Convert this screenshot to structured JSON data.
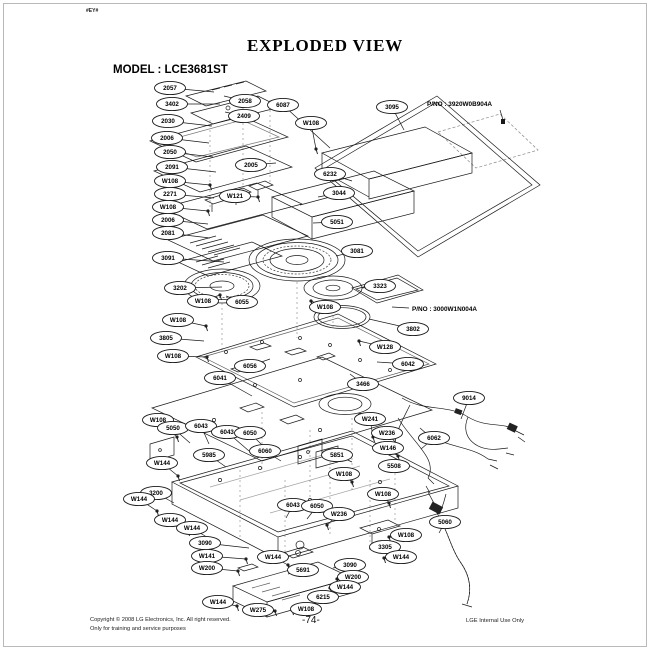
{
  "page": {
    "corner_mark": "#EY#",
    "title": "EXPLODED VIEW",
    "model_label": "MODEL : LCE3681ST",
    "footer": {
      "copyright_line1": "Copyright © 2008 LG Electronics, Inc. All right reserved.",
      "copyright_line2": "Only for training and service purposes",
      "page_number": "-74-",
      "right_note": "LGE Internal Use Only"
    }
  },
  "diagram": {
    "pno_labels": [
      {
        "text": "P/NO : 3920W0B904A",
        "x": 427,
        "y": 106,
        "lx": 500,
        "ly": 110,
        "tx": 503,
        "ty": 120
      },
      {
        "text": "P/NO : 3000W1N004A",
        "x": 412,
        "y": 311,
        "lx": 409,
        "ly": 308,
        "tx": 392,
        "ty": 307
      }
    ],
    "part_labels": [
      {
        "label": "2057",
        "x": 170,
        "y": 88,
        "tx": 214,
        "ty": 92
      },
      {
        "label": "3402",
        "x": 172,
        "y": 104,
        "tx": 220,
        "ty": 104
      },
      {
        "label": "2030",
        "x": 168,
        "y": 121,
        "tx": 212,
        "ty": 126
      },
      {
        "label": "2006",
        "x": 167,
        "y": 138,
        "tx": 209,
        "ty": 143
      },
      {
        "label": "2050",
        "x": 170,
        "y": 152,
        "tx": 213,
        "ty": 157
      },
      {
        "label": "2091",
        "x": 172,
        "y": 167,
        "tx": 216,
        "ty": 172
      },
      {
        "label": "W108",
        "x": 170,
        "y": 181,
        "tx": 210,
        "ty": 185
      },
      {
        "label": "2271",
        "x": 170,
        "y": 194,
        "tx": 214,
        "ty": 198
      },
      {
        "label": "W108",
        "x": 168,
        "y": 207,
        "tx": 208,
        "ty": 211
      },
      {
        "label": "2006",
        "x": 168,
        "y": 220,
        "tx": 208,
        "ty": 224
      },
      {
        "label": "2081",
        "x": 168,
        "y": 233,
        "tx": 210,
        "ty": 238
      },
      {
        "label": "3091",
        "x": 168,
        "y": 258,
        "tx": 224,
        "ty": 262
      },
      {
        "label": "3202",
        "x": 180,
        "y": 288,
        "tx": 222,
        "ty": 287
      },
      {
        "label": "W108",
        "x": 203,
        "y": 301,
        "tx": 220,
        "ty": 295
      },
      {
        "label": "6055",
        "x": 242,
        "y": 302,
        "tx": 226,
        "ty": 296
      },
      {
        "label": "W108",
        "x": 178,
        "y": 320,
        "tx": 206,
        "ty": 326
      },
      {
        "label": "3805",
        "x": 166,
        "y": 338,
        "tx": 204,
        "ty": 341
      },
      {
        "label": "W108",
        "x": 173,
        "y": 356,
        "tx": 207,
        "ty": 357
      },
      {
        "label": "2058",
        "x": 245,
        "y": 101,
        "tx": 224,
        "ty": 96
      },
      {
        "label": "2409",
        "x": 244,
        "y": 116,
        "tx": 225,
        "ty": 112
      },
      {
        "label": "6087",
        "x": 283,
        "y": 105,
        "tx": 330,
        "ty": 148
      },
      {
        "label": "W108",
        "x": 311,
        "y": 123,
        "tx": 316,
        "ty": 149
      },
      {
        "label": "3095",
        "x": 392,
        "y": 107,
        "tx": 404,
        "ty": 130
      },
      {
        "label": "2005",
        "x": 251,
        "y": 165,
        "tx": 276,
        "ty": 163
      },
      {
        "label": "W121",
        "x": 235,
        "y": 196,
        "tx": 258,
        "ty": 197
      },
      {
        "label": "6232",
        "x": 330,
        "y": 174,
        "tx": 352,
        "ty": 181
      },
      {
        "label": "3044",
        "x": 339,
        "y": 193,
        "tx": 318,
        "ty": 197
      },
      {
        "label": "5051",
        "x": 337,
        "y": 222,
        "tx": 313,
        "ty": 223
      },
      {
        "label": "3081",
        "x": 357,
        "y": 251,
        "tx": 336,
        "ty": 256
      },
      {
        "label": "3323",
        "x": 380,
        "y": 286,
        "tx": 362,
        "ty": 288
      },
      {
        "label": "W108",
        "x": 325,
        "y": 307,
        "tx": 311,
        "ty": 301
      },
      {
        "label": "3802",
        "x": 413,
        "y": 329,
        "tx": 369,
        "ty": 319
      },
      {
        "label": "W128",
        "x": 385,
        "y": 347,
        "tx": 359,
        "ty": 341
      },
      {
        "label": "6042",
        "x": 408,
        "y": 364,
        "tx": 377,
        "ty": 362
      },
      {
        "label": "3466",
        "x": 363,
        "y": 384,
        "tx": 350,
        "ty": 374
      },
      {
        "label": "6056",
        "x": 250,
        "y": 366,
        "tx": 270,
        "ty": 359
      },
      {
        "label": "6041",
        "x": 220,
        "y": 378,
        "tx": 252,
        "ty": 396
      },
      {
        "label": "9014",
        "x": 469,
        "y": 398,
        "tx": 461,
        "ty": 419
      },
      {
        "label": "W241",
        "x": 370,
        "y": 419,
        "tx": 373,
        "ty": 437
      },
      {
        "label": "W236",
        "x": 387,
        "y": 433,
        "tx": 397,
        "ty": 444
      },
      {
        "label": "W146",
        "x": 388,
        "y": 448,
        "tx": 398,
        "ty": 456
      },
      {
        "label": "6062",
        "x": 434,
        "y": 438,
        "tx": 421,
        "ty": 449
      },
      {
        "label": "5508",
        "x": 394,
        "y": 466,
        "tx": 401,
        "ty": 472
      },
      {
        "label": "W108",
        "x": 158,
        "y": 420,
        "tx": 177,
        "ty": 437
      },
      {
        "label": "5050",
        "x": 173,
        "y": 428,
        "tx": 190,
        "ty": 443
      },
      {
        "label": "6043",
        "x": 201,
        "y": 426,
        "tx": 209,
        "ty": 444
      },
      {
        "label": "6043",
        "x": 227,
        "y": 432,
        "tx": 249,
        "ty": 451
      },
      {
        "label": "6050",
        "x": 250,
        "y": 433,
        "tx": 268,
        "ty": 451
      },
      {
        "label": "6060",
        "x": 265,
        "y": 451,
        "tx": 281,
        "ty": 461
      },
      {
        "label": "5985",
        "x": 209,
        "y": 455,
        "tx": 226,
        "ty": 467
      },
      {
        "label": "5851",
        "x": 337,
        "y": 455,
        "tx": 352,
        "ty": 462
      },
      {
        "label": "W144",
        "x": 162,
        "y": 463,
        "tx": 178,
        "ty": 476
      },
      {
        "label": "W108",
        "x": 344,
        "y": 474,
        "tx": 352,
        "ty": 482
      },
      {
        "label": "3200",
        "x": 156,
        "y": 493,
        "tx": 174,
        "ty": 503
      },
      {
        "label": "W144",
        "x": 139,
        "y": 499,
        "tx": 157,
        "ty": 511
      },
      {
        "label": "6043",
        "x": 293,
        "y": 505,
        "tx": 286,
        "ty": 518
      },
      {
        "label": "6050",
        "x": 317,
        "y": 506,
        "tx": 307,
        "ty": 519
      },
      {
        "label": "W236",
        "x": 339,
        "y": 514,
        "tx": 327,
        "ty": 525
      },
      {
        "label": "W144",
        "x": 170,
        "y": 520,
        "tx": 188,
        "ty": 531
      },
      {
        "label": "W144",
        "x": 192,
        "y": 528,
        "tx": 210,
        "ty": 539
      },
      {
        "label": "3090",
        "x": 205,
        "y": 543,
        "tx": 249,
        "ty": 548
      },
      {
        "label": "W141",
        "x": 207,
        "y": 556,
        "tx": 246,
        "ty": 559
      },
      {
        "label": "W200",
        "x": 207,
        "y": 568,
        "tx": 238,
        "ty": 571
      },
      {
        "label": "W144",
        "x": 273,
        "y": 557,
        "tx": 288,
        "ty": 565
      },
      {
        "label": "5691",
        "x": 303,
        "y": 570,
        "tx": 288,
        "ty": 574
      },
      {
        "label": "3090",
        "x": 350,
        "y": 565,
        "tx": 333,
        "ty": 568
      },
      {
        "label": "W200",
        "x": 353,
        "y": 577,
        "tx": 337,
        "ty": 579
      },
      {
        "label": "W144",
        "x": 345,
        "y": 587,
        "tx": 330,
        "ty": 588
      },
      {
        "label": "6215",
        "x": 323,
        "y": 597,
        "tx": 312,
        "ty": 599
      },
      {
        "label": "W144",
        "x": 218,
        "y": 602,
        "tx": 237,
        "ty": 606
      },
      {
        "label": "W275",
        "x": 258,
        "y": 610,
        "tx": 275,
        "ty": 611
      },
      {
        "label": "W108",
        "x": 306,
        "y": 609,
        "tx": 292,
        "ty": 610
      },
      {
        "label": "W108",
        "x": 383,
        "y": 494,
        "tx": 389,
        "ty": 503
      },
      {
        "label": "W108",
        "x": 406,
        "y": 535,
        "tx": 389,
        "ty": 537
      },
      {
        "label": "3305",
        "x": 385,
        "y": 547,
        "tx": 369,
        "ty": 549
      },
      {
        "label": "W144",
        "x": 401,
        "y": 557,
        "tx": 384,
        "ty": 558
      },
      {
        "label": "5060",
        "x": 445,
        "y": 522,
        "tx": 439,
        "ty": 533
      }
    ]
  }
}
